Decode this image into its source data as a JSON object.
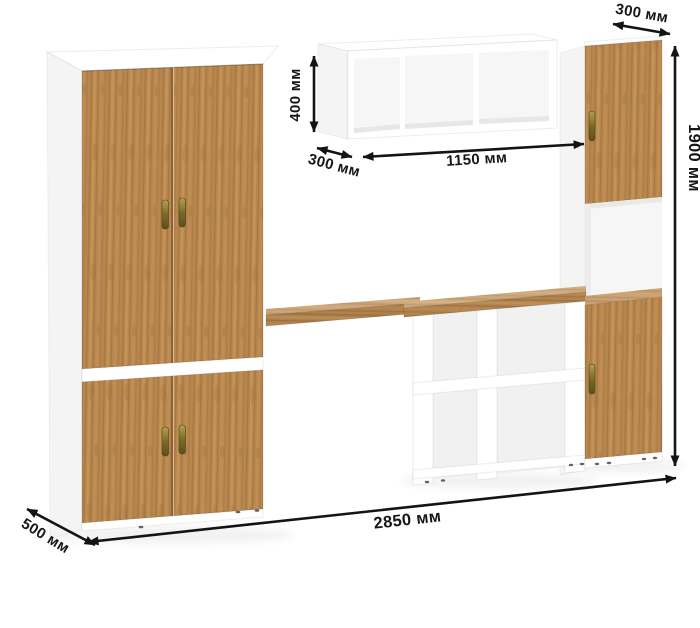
{
  "dims": {
    "top_depth": "300 мм",
    "total_height": "1900 мм",
    "shelf_height": "400 мм",
    "shelf_depth": "300 мм",
    "shelf_width": "1150 мм",
    "total_width": "2850 мм",
    "side_depth": "500 мм"
  },
  "colors": {
    "dimension_ink": "#141414",
    "wood": "#b78750",
    "wood_light": "#c79757",
    "carcass_white": "#ffffff",
    "brass_handle": "#8d7d35",
    "background": "#ffffff"
  }
}
